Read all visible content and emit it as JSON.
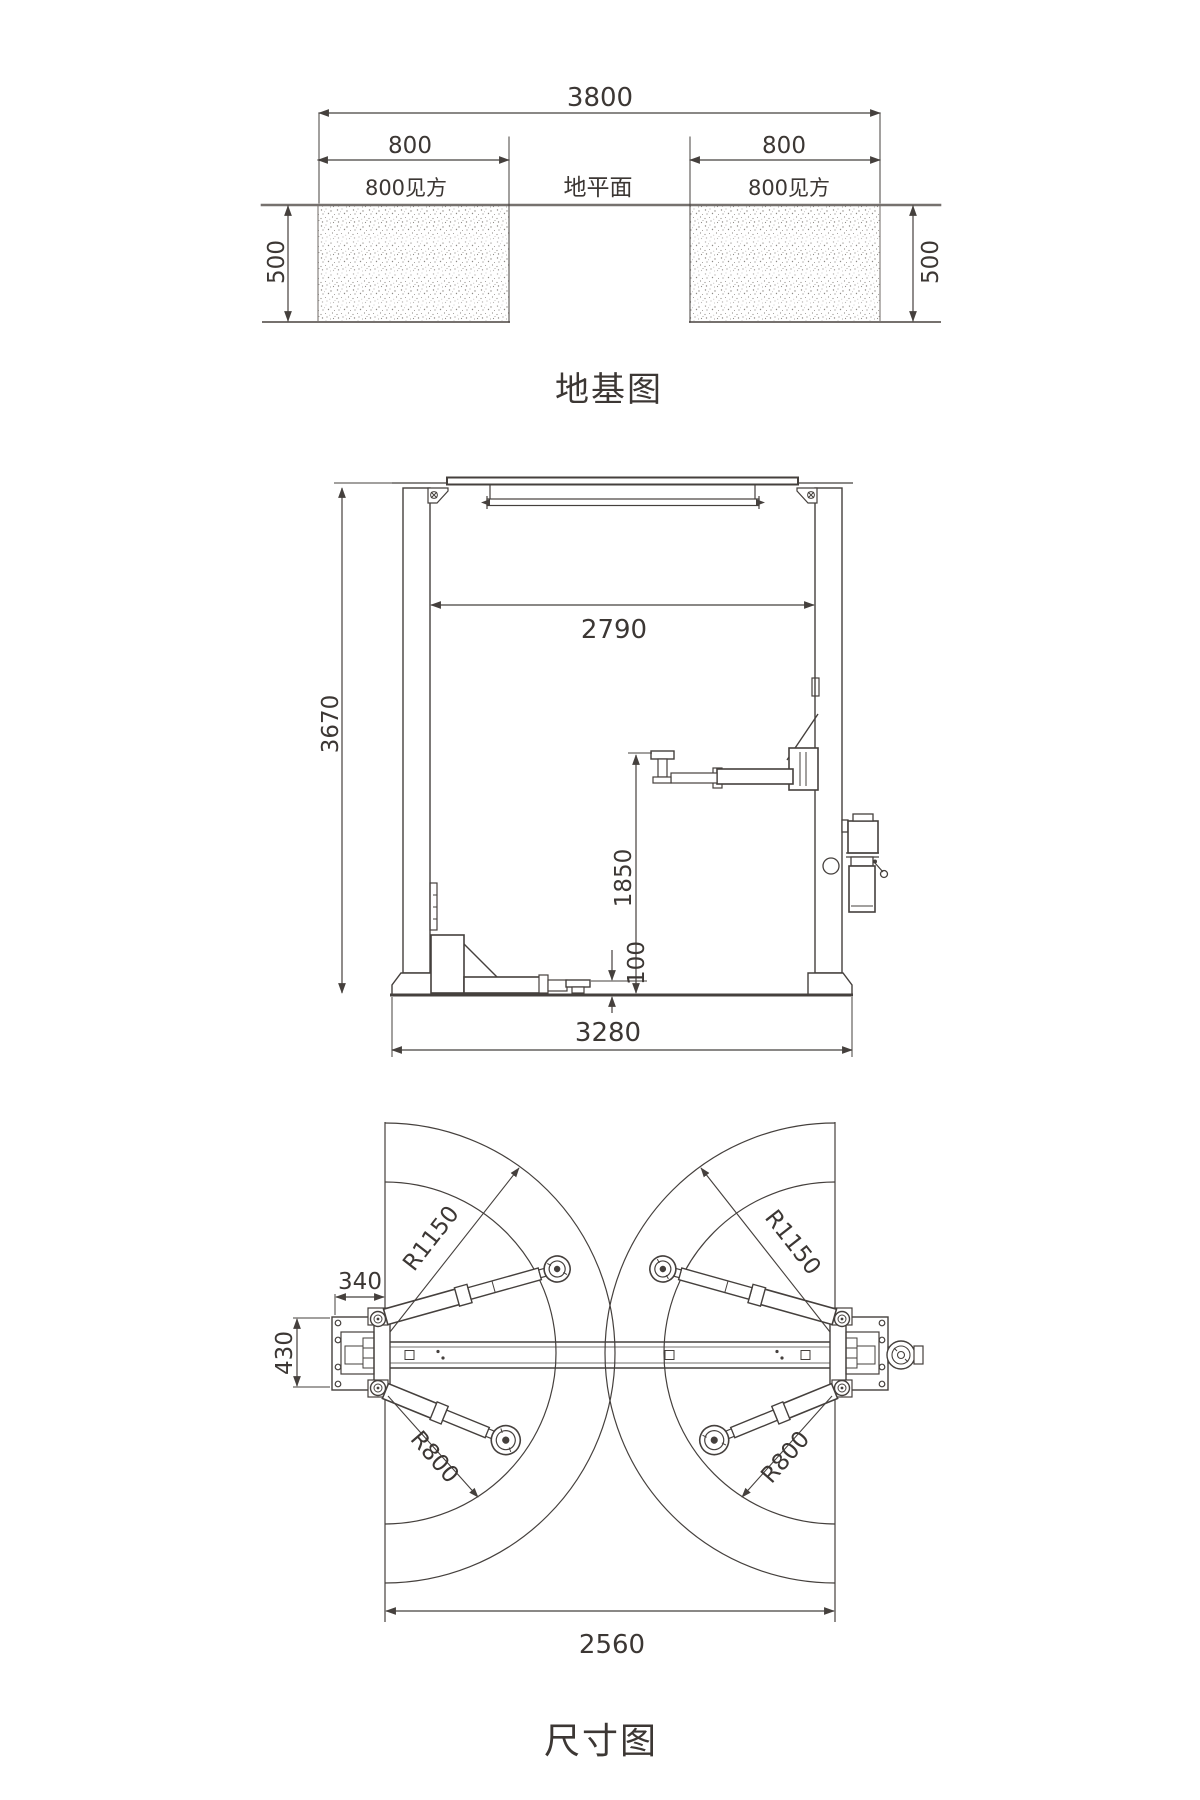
{
  "document": {
    "background": "#ffffff",
    "ink_color": "#45403d",
    "ground_line_color": "#76716e"
  },
  "foundation_view": {
    "title": "地基图",
    "overall_width": "3800",
    "ground_label": "地平面",
    "pad_left": {
      "width": "800",
      "square_note": "800见方",
      "depth": "500"
    },
    "pad_right": {
      "width": "800",
      "square_note": "800见方",
      "depth": "500"
    }
  },
  "elevation_view": {
    "overall_height": "3670",
    "clear_width": "2790",
    "lift_height": "1850",
    "min_pad_height": "100",
    "base_width": "3280"
  },
  "plan_view": {
    "title": "尺寸图",
    "column_offset": "340",
    "base_depth": "430",
    "arm_reach_max_left": "R1150",
    "arm_reach_max_right": "R1150",
    "arm_reach_min_left": "R800",
    "arm_reach_min_right": "R800",
    "drive_through_width": "2560"
  }
}
